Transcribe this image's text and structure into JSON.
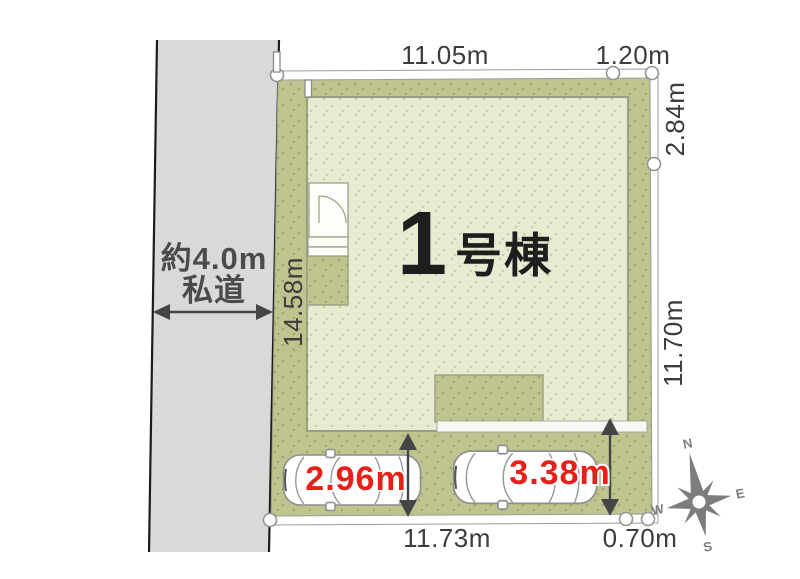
{
  "colors": {
    "plot_green": "#bfc48e",
    "plot_dot": "#a0a872",
    "building_fill": "#e8ebd1",
    "building_dot": "#c9cfa2",
    "road_gray": "#d9d9d9",
    "outline": "#9aa083",
    "dim_text": "#3c3c3c",
    "road_text": "#4b4b4b",
    "building_text": "#1e1e1e",
    "red_accent": "#e72119",
    "compass_gray": "#7d7d7d"
  },
  "road": {
    "width_label": "約4.0m",
    "type_label": "私道"
  },
  "building": {
    "number": "1",
    "suffix": "号棟"
  },
  "dimensions": {
    "top": "11.05m",
    "top_right": "1.20m",
    "right_upper": "2.84m",
    "right_lower": "11.70m",
    "left": "14.58m",
    "bottom": "11.73m",
    "bottom_right": "0.70m"
  },
  "parking": {
    "space_1_depth": "2.96m",
    "space_2_depth": "3.38m"
  },
  "compass": {
    "north": "N",
    "east": "E",
    "south": "S",
    "west": "W"
  }
}
